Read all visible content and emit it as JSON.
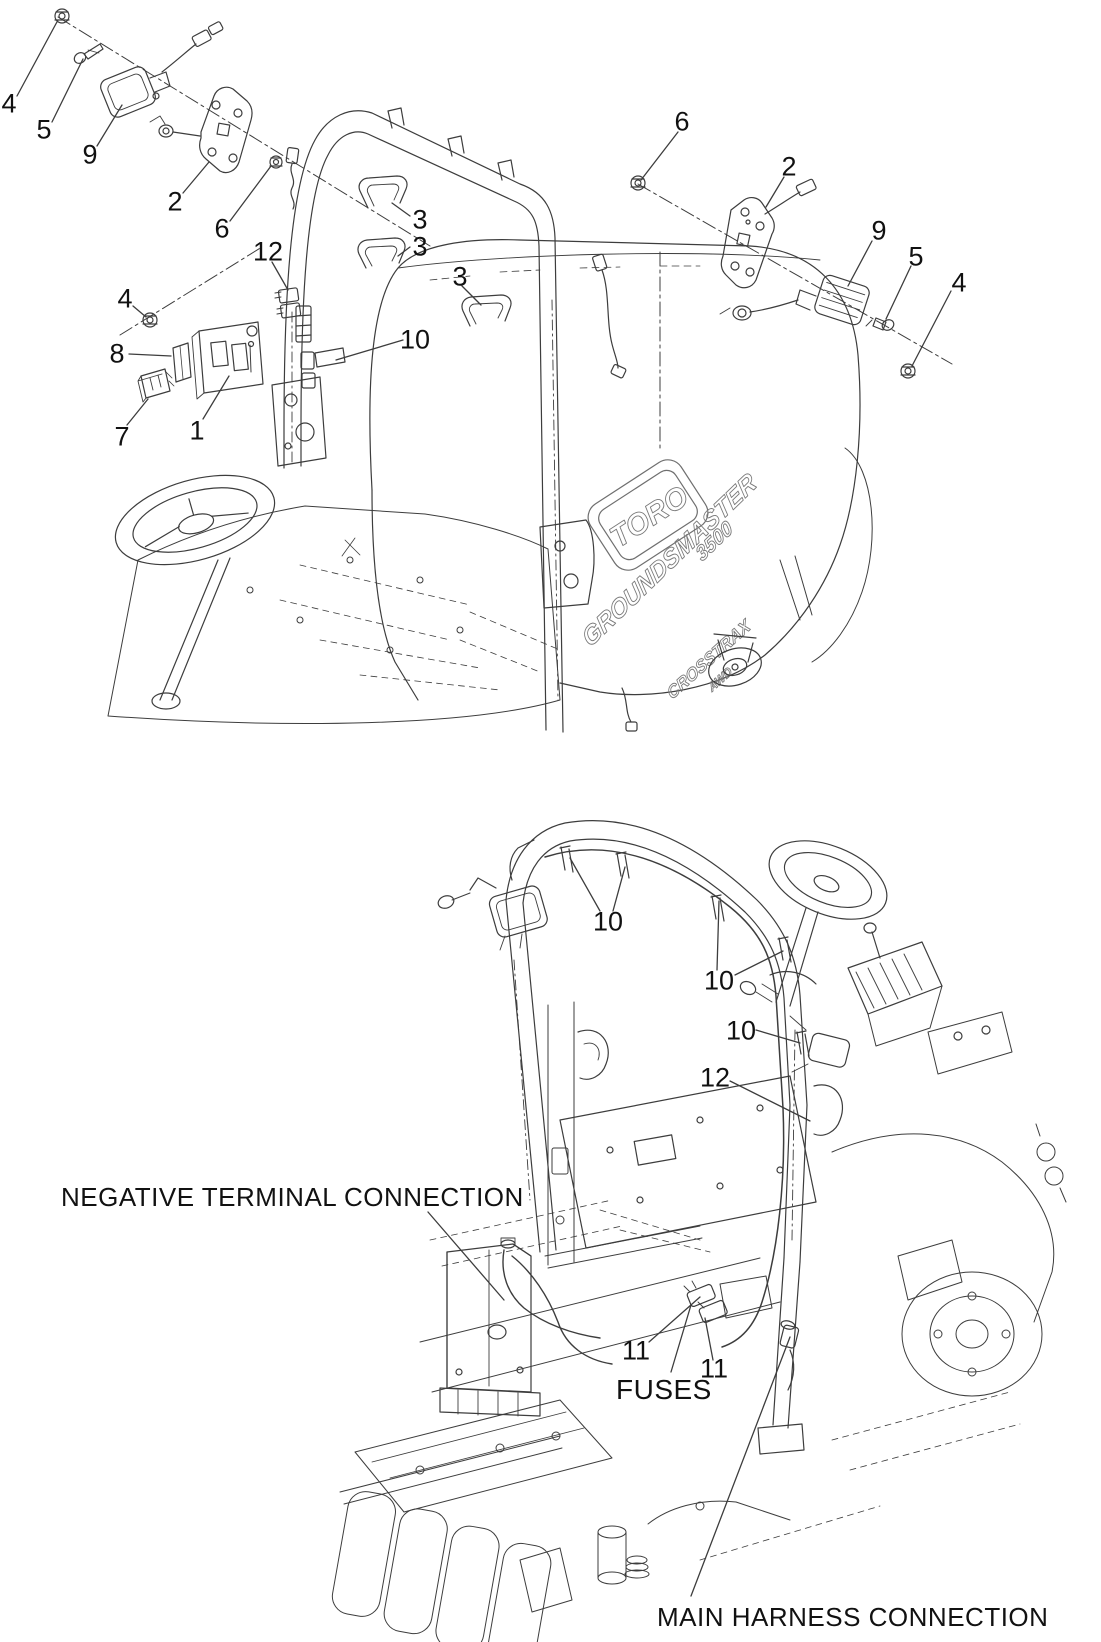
{
  "diagram_type": "exploded-parts-diagram",
  "product": {
    "brand": "TORO",
    "model": "GROUNDSMASTER",
    "model_number": "3500",
    "decal_line1": "CROSSTRAX",
    "decal_line2": "AWD"
  },
  "callouts_top": [
    {
      "id": "t0",
      "label": "4"
    },
    {
      "id": "t1",
      "label": "5"
    },
    {
      "id": "t2",
      "label": "9"
    },
    {
      "id": "t3",
      "label": "2"
    },
    {
      "id": "t4",
      "label": "6"
    },
    {
      "id": "t5",
      "label": "12"
    },
    {
      "id": "t6",
      "label": "3"
    },
    {
      "id": "t7",
      "label": "3"
    },
    {
      "id": "t8",
      "label": "3"
    },
    {
      "id": "t9",
      "label": "10"
    },
    {
      "id": "t10",
      "label": "4"
    },
    {
      "id": "t11",
      "label": "8"
    },
    {
      "id": "t12",
      "label": "7"
    },
    {
      "id": "t13",
      "label": "1"
    },
    {
      "id": "t14",
      "label": "6"
    },
    {
      "id": "t15",
      "label": "2"
    },
    {
      "id": "t16",
      "label": "9"
    },
    {
      "id": "t17",
      "label": "5"
    },
    {
      "id": "t18",
      "label": "4"
    }
  ],
  "callouts_bottom": [
    {
      "id": "b0",
      "label": "10"
    },
    {
      "id": "b1",
      "label": "10"
    },
    {
      "id": "b2",
      "label": "10"
    },
    {
      "id": "b3",
      "label": "12"
    },
    {
      "id": "b4",
      "label": "11"
    },
    {
      "id": "b5",
      "label": "11"
    }
  ],
  "annotations": {
    "negative_terminal": "NEGATIVE TERMINAL CONNECTION",
    "fuses": "FUSES",
    "main_harness": "MAIN HARNESS CONNECTION"
  },
  "colors": {
    "line": "#3d3d3d",
    "text": "#111111",
    "background": "#ffffff"
  }
}
